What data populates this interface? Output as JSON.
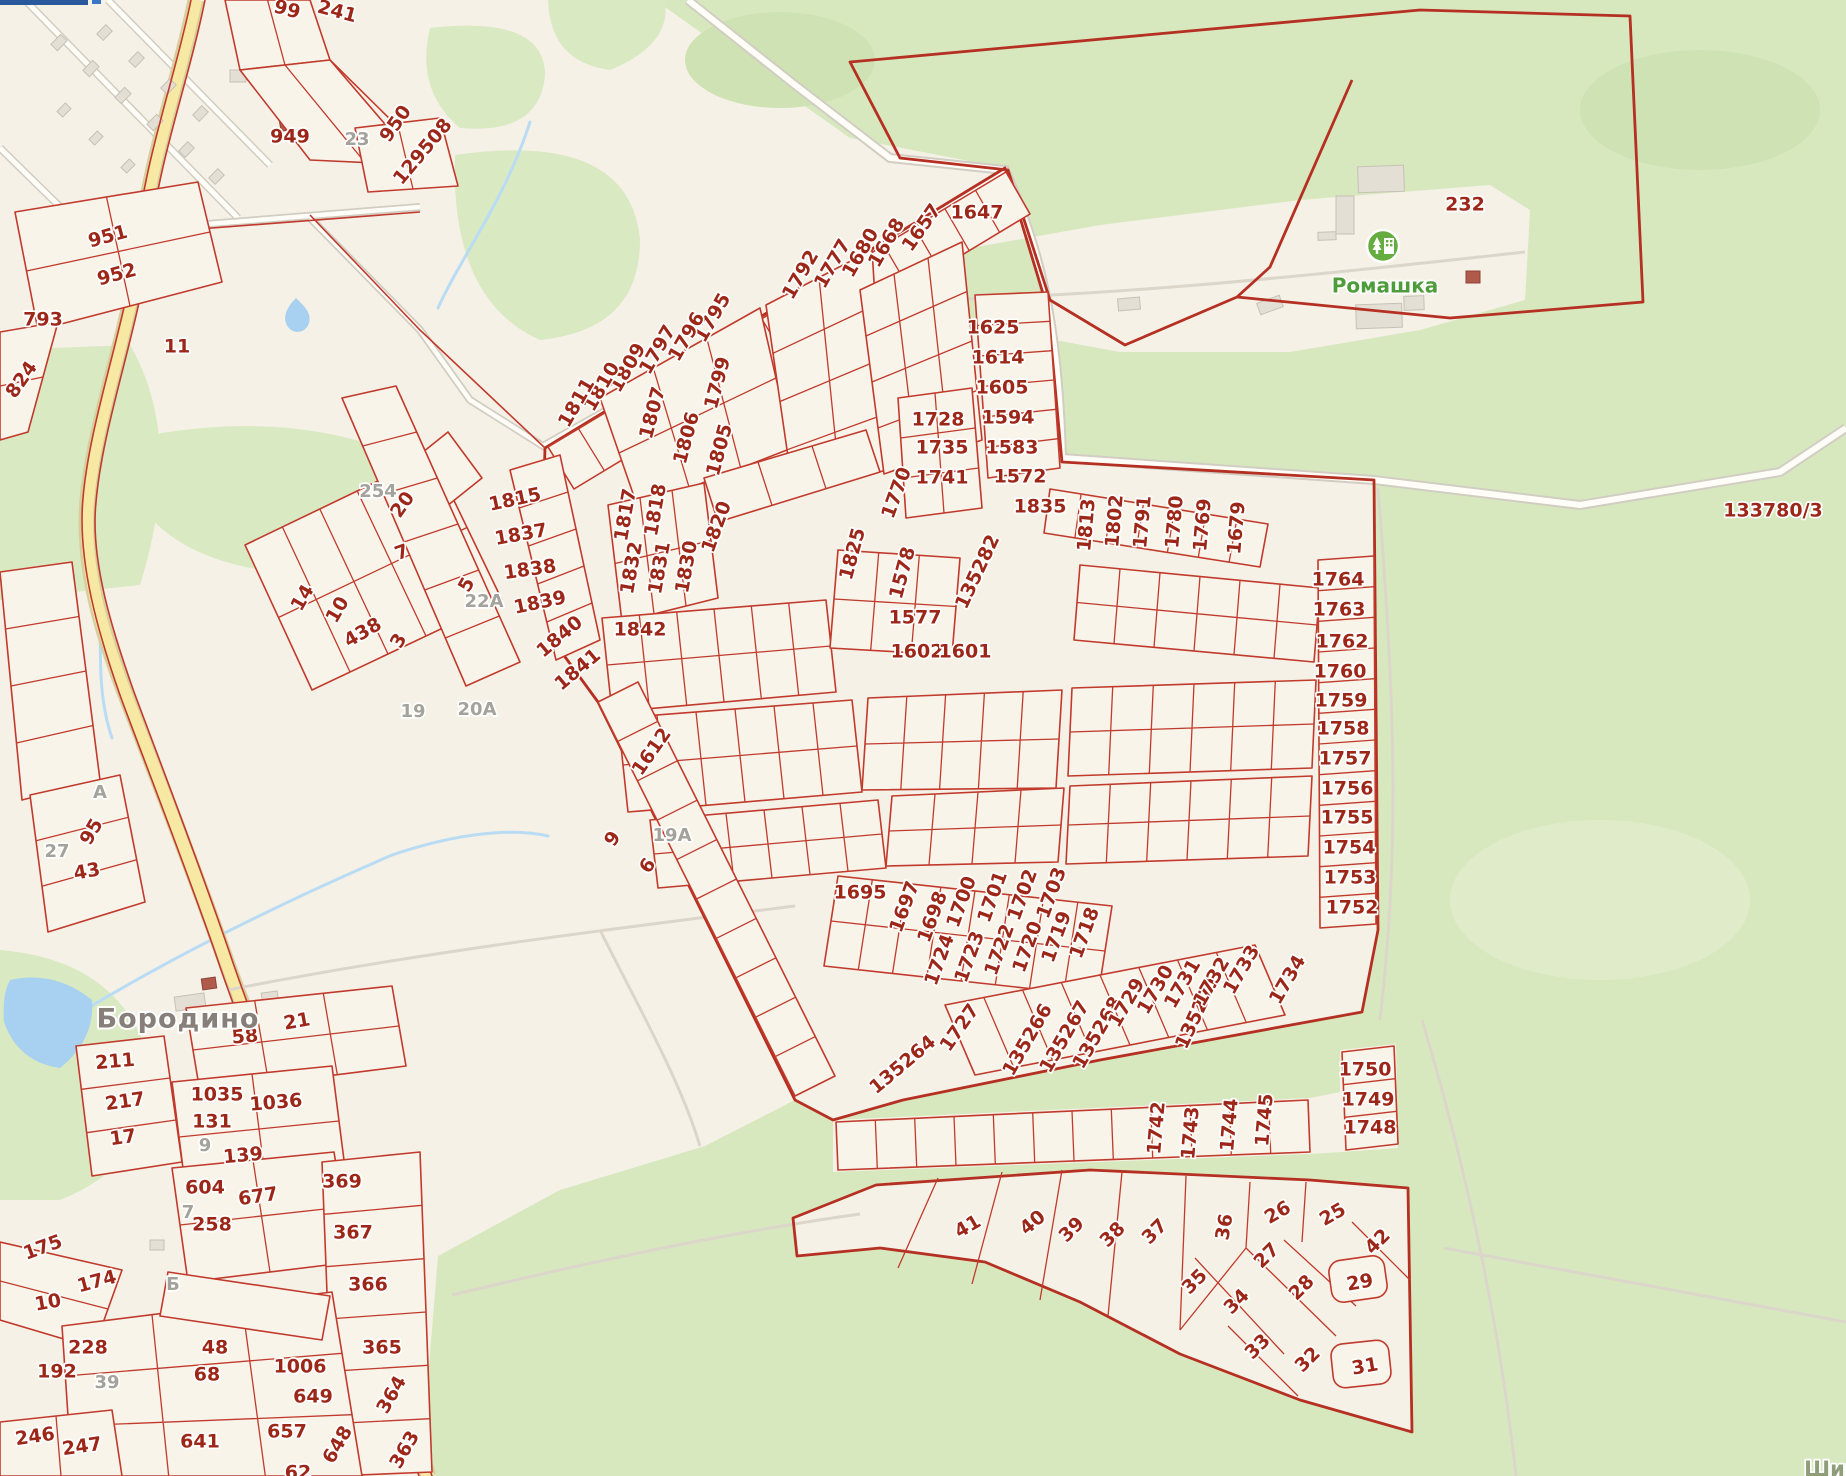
{
  "map": {
    "type": "cadastral-map",
    "colors": {
      "background": "#f5f1e6",
      "forest_green": "#d7e8bf",
      "parcel_line_red": "#c13a2c",
      "label_red": "#9c2718",
      "label_grey": "#a3a39b",
      "water_blue": "#a8d0f0",
      "road_yellow": "#f7e9a4",
      "poi_green": "#66ad41"
    },
    "places": [
      {
        "text": "Бородино",
        "x": 178,
        "y": 1020,
        "r": 0,
        "kind": "place"
      },
      {
        "text": "Ромашка",
        "x": 1385,
        "y": 287,
        "r": 0,
        "kind": "green"
      },
      {
        "text": "Шир",
        "x": 1832,
        "y": 1470,
        "r": 0,
        "kind": "street"
      }
    ],
    "poi": [
      {
        "name": "romashka-settlement-icon",
        "x": 1383,
        "y": 246
      }
    ],
    "parcels": [
      {
        "t": "99",
        "x": 287,
        "y": 10,
        "r": 15
      },
      {
        "t": "241",
        "x": 337,
        "y": 12,
        "r": 15
      },
      {
        "t": "950",
        "x": 396,
        "y": 124,
        "r": -55
      },
      {
        "t": "949",
        "x": 290,
        "y": 137,
        "r": 0
      },
      {
        "t": "23",
        "x": 357,
        "y": 140,
        "r": 0,
        "k": "grey"
      },
      {
        "t": "129508",
        "x": 423,
        "y": 152,
        "r": -50
      },
      {
        "t": "951",
        "x": 108,
        "y": 237,
        "r": -15
      },
      {
        "t": "952",
        "x": 117,
        "y": 275,
        "r": -15
      },
      {
        "t": "793",
        "x": 43,
        "y": 320,
        "r": 0
      },
      {
        "t": "11",
        "x": 177,
        "y": 347,
        "r": 0
      },
      {
        "t": "824",
        "x": 22,
        "y": 380,
        "r": -55
      },
      {
        "t": "254",
        "x": 378,
        "y": 492,
        "r": 0,
        "k": "grey"
      },
      {
        "t": "20",
        "x": 403,
        "y": 505,
        "r": -55
      },
      {
        "t": "7",
        "x": 402,
        "y": 553,
        "r": -20
      },
      {
        "t": "5",
        "x": 467,
        "y": 585,
        "r": -60
      },
      {
        "t": "22А",
        "x": 484,
        "y": 602,
        "r": 0,
        "k": "grey"
      },
      {
        "t": "14",
        "x": 303,
        "y": 598,
        "r": -60
      },
      {
        "t": "10",
        "x": 338,
        "y": 610,
        "r": -60
      },
      {
        "t": "438",
        "x": 363,
        "y": 633,
        "r": -30
      },
      {
        "t": "3",
        "x": 399,
        "y": 641,
        "r": -60
      },
      {
        "t": "19",
        "x": 413,
        "y": 712,
        "r": 0,
        "k": "grey"
      },
      {
        "t": "20А",
        "x": 477,
        "y": 710,
        "r": 0,
        "k": "grey"
      },
      {
        "t": "1647",
        "x": 977,
        "y": 213,
        "r": 0
      },
      {
        "t": "1657",
        "x": 922,
        "y": 228,
        "r": -55
      },
      {
        "t": "1668",
        "x": 887,
        "y": 243,
        "r": -60
      },
      {
        "t": "1680",
        "x": 861,
        "y": 253,
        "r": -60
      },
      {
        "t": "1777",
        "x": 833,
        "y": 264,
        "r": -60
      },
      {
        "t": "1792",
        "x": 801,
        "y": 275,
        "r": -60
      },
      {
        "t": "1795",
        "x": 713,
        "y": 318,
        "r": -60
      },
      {
        "t": "1796",
        "x": 687,
        "y": 337,
        "r": -60
      },
      {
        "t": "1797",
        "x": 658,
        "y": 350,
        "r": -60
      },
      {
        "t": "1809",
        "x": 628,
        "y": 368,
        "r": -60
      },
      {
        "t": "1810",
        "x": 602,
        "y": 387,
        "r": -60
      },
      {
        "t": "1811",
        "x": 577,
        "y": 403,
        "r": -60
      },
      {
        "t": "1799",
        "x": 718,
        "y": 383,
        "r": -75
      },
      {
        "t": "1807",
        "x": 653,
        "y": 413,
        "r": -75
      },
      {
        "t": "1806",
        "x": 687,
        "y": 438,
        "r": -75
      },
      {
        "t": "1805",
        "x": 720,
        "y": 450,
        "r": -75
      },
      {
        "t": "1625",
        "x": 993,
        "y": 328,
        "r": 0
      },
      {
        "t": "1614",
        "x": 998,
        "y": 358,
        "r": 0
      },
      {
        "t": "1605",
        "x": 1002,
        "y": 388,
        "r": 0
      },
      {
        "t": "1594",
        "x": 1008,
        "y": 418,
        "r": 0
      },
      {
        "t": "1583",
        "x": 1012,
        "y": 448,
        "r": 0
      },
      {
        "t": "1572",
        "x": 1020,
        "y": 477,
        "r": 0
      },
      {
        "t": "1728",
        "x": 938,
        "y": 420,
        "r": 0
      },
      {
        "t": "1735",
        "x": 942,
        "y": 448,
        "r": 0
      },
      {
        "t": "1741",
        "x": 942,
        "y": 478,
        "r": 0
      },
      {
        "t": "1770",
        "x": 897,
        "y": 493,
        "r": -70
      },
      {
        "t": "1835",
        "x": 1040,
        "y": 507,
        "r": 0
      },
      {
        "t": "1815",
        "x": 515,
        "y": 500,
        "r": -12
      },
      {
        "t": "1837",
        "x": 521,
        "y": 535,
        "r": -10
      },
      {
        "t": "1838",
        "x": 530,
        "y": 570,
        "r": -8
      },
      {
        "t": "1839",
        "x": 540,
        "y": 603,
        "r": -12
      },
      {
        "t": "1840",
        "x": 560,
        "y": 637,
        "r": -40
      },
      {
        "t": "1841",
        "x": 578,
        "y": 670,
        "r": -40
      },
      {
        "t": "1842",
        "x": 640,
        "y": 630,
        "r": 0
      },
      {
        "t": "1817",
        "x": 626,
        "y": 515,
        "r": -80
      },
      {
        "t": "1818",
        "x": 656,
        "y": 510,
        "r": -80
      },
      {
        "t": "1832",
        "x": 632,
        "y": 568,
        "r": -80
      },
      {
        "t": "1831",
        "x": 660,
        "y": 568,
        "r": -80
      },
      {
        "t": "1830",
        "x": 687,
        "y": 567,
        "r": -80
      },
      {
        "t": "1820",
        "x": 717,
        "y": 527,
        "r": -70
      },
      {
        "t": "1825",
        "x": 853,
        "y": 554,
        "r": -75
      },
      {
        "t": "1578",
        "x": 903,
        "y": 573,
        "r": -75
      },
      {
        "t": "1577",
        "x": 915,
        "y": 618,
        "r": 0
      },
      {
        "t": "1602",
        "x": 917,
        "y": 652,
        "r": 0
      },
      {
        "t": "1601",
        "x": 965,
        "y": 652,
        "r": 0
      },
      {
        "t": "135282",
        "x": 978,
        "y": 572,
        "r": -65
      },
      {
        "t": "1612",
        "x": 652,
        "y": 752,
        "r": -55
      },
      {
        "t": "9",
        "x": 613,
        "y": 839,
        "r": -55
      },
      {
        "t": "6",
        "x": 648,
        "y": 866,
        "r": -55
      },
      {
        "t": "19А",
        "x": 672,
        "y": 836,
        "r": 0,
        "k": "grey"
      },
      {
        "t": "1813",
        "x": 1087,
        "y": 525,
        "r": -85
      },
      {
        "t": "1802",
        "x": 1115,
        "y": 521,
        "r": -85
      },
      {
        "t": "1791",
        "x": 1143,
        "y": 522,
        "r": -85
      },
      {
        "t": "1780",
        "x": 1175,
        "y": 522,
        "r": -85
      },
      {
        "t": "1769",
        "x": 1203,
        "y": 525,
        "r": -85
      },
      {
        "t": "1679",
        "x": 1237,
        "y": 528,
        "r": -85
      },
      {
        "t": "1764",
        "x": 1338,
        "y": 580,
        "r": 0
      },
      {
        "t": "1763",
        "x": 1339,
        "y": 610,
        "r": 0
      },
      {
        "t": "1762",
        "x": 1342,
        "y": 642,
        "r": 0
      },
      {
        "t": "1760",
        "x": 1340,
        "y": 672,
        "r": 0
      },
      {
        "t": "1759",
        "x": 1341,
        "y": 701,
        "r": 0
      },
      {
        "t": "1758",
        "x": 1343,
        "y": 729,
        "r": 0
      },
      {
        "t": "1757",
        "x": 1345,
        "y": 759,
        "r": 0
      },
      {
        "t": "1756",
        "x": 1347,
        "y": 789,
        "r": 0
      },
      {
        "t": "1755",
        "x": 1347,
        "y": 818,
        "r": 0
      },
      {
        "t": "1754",
        "x": 1349,
        "y": 848,
        "r": 0
      },
      {
        "t": "1753",
        "x": 1350,
        "y": 878,
        "r": 0
      },
      {
        "t": "1752",
        "x": 1352,
        "y": 908,
        "r": 0
      },
      {
        "t": "1695",
        "x": 860,
        "y": 893,
        "r": 0
      },
      {
        "t": "1697",
        "x": 905,
        "y": 907,
        "r": -70
      },
      {
        "t": "1698",
        "x": 933,
        "y": 917,
        "r": -70
      },
      {
        "t": "1700",
        "x": 962,
        "y": 902,
        "r": -70
      },
      {
        "t": "1701",
        "x": 993,
        "y": 897,
        "r": -70
      },
      {
        "t": "1702",
        "x": 1023,
        "y": 895,
        "r": -70
      },
      {
        "t": "1703",
        "x": 1052,
        "y": 893,
        "r": -70
      },
      {
        "t": "1719",
        "x": 1057,
        "y": 937,
        "r": -70
      },
      {
        "t": "1718",
        "x": 1085,
        "y": 933,
        "r": -70
      },
      {
        "t": "1724",
        "x": 940,
        "y": 960,
        "r": -70
      },
      {
        "t": "1723",
        "x": 970,
        "y": 957,
        "r": -70
      },
      {
        "t": "1722",
        "x": 1000,
        "y": 950,
        "r": -70
      },
      {
        "t": "1720",
        "x": 1028,
        "y": 947,
        "r": -70
      },
      {
        "t": "1727",
        "x": 960,
        "y": 1028,
        "r": -55
      },
      {
        "t": "135264",
        "x": 903,
        "y": 1065,
        "r": -40
      },
      {
        "t": "135266",
        "x": 1028,
        "y": 1040,
        "r": -60
      },
      {
        "t": "135267",
        "x": 1065,
        "y": 1037,
        "r": -60
      },
      {
        "t": "135268",
        "x": 1098,
        "y": 1033,
        "r": -60
      },
      {
        "t": "1729",
        "x": 1127,
        "y": 1003,
        "r": -60
      },
      {
        "t": "1730",
        "x": 1156,
        "y": 990,
        "r": -60
      },
      {
        "t": "1731",
        "x": 1183,
        "y": 984,
        "r": -60
      },
      {
        "t": "135271",
        "x": 1198,
        "y": 1012,
        "r": -65
      },
      {
        "t": "1732",
        "x": 1212,
        "y": 982,
        "r": -60
      },
      {
        "t": "1733",
        "x": 1242,
        "y": 970,
        "r": -60
      },
      {
        "t": "1734",
        "x": 1288,
        "y": 980,
        "r": -60
      },
      {
        "t": "1742",
        "x": 1157,
        "y": 1128,
        "r": -85
      },
      {
        "t": "1743",
        "x": 1191,
        "y": 1133,
        "r": -85
      },
      {
        "t": "1744",
        "x": 1230,
        "y": 1125,
        "r": -85
      },
      {
        "t": "1745",
        "x": 1265,
        "y": 1120,
        "r": -85
      },
      {
        "t": "1750",
        "x": 1365,
        "y": 1070,
        "r": 0
      },
      {
        "t": "1749",
        "x": 1368,
        "y": 1100,
        "r": 0
      },
      {
        "t": "1748",
        "x": 1370,
        "y": 1128,
        "r": 0
      },
      {
        "t": "41",
        "x": 968,
        "y": 1227,
        "r": -30
      },
      {
        "t": "40",
        "x": 1033,
        "y": 1223,
        "r": -40
      },
      {
        "t": "39",
        "x": 1072,
        "y": 1230,
        "r": -45
      },
      {
        "t": "38",
        "x": 1113,
        "y": 1235,
        "r": -45
      },
      {
        "t": "37",
        "x": 1155,
        "y": 1232,
        "r": -45
      },
      {
        "t": "36",
        "x": 1225,
        "y": 1227,
        "r": -80
      },
      {
        "t": "35",
        "x": 1195,
        "y": 1282,
        "r": -45
      },
      {
        "t": "34",
        "x": 1237,
        "y": 1302,
        "r": -45
      },
      {
        "t": "33",
        "x": 1258,
        "y": 1347,
        "r": -45
      },
      {
        "t": "32",
        "x": 1308,
        "y": 1360,
        "r": -45
      },
      {
        "t": "31",
        "x": 1365,
        "y": 1367,
        "r": -10
      },
      {
        "t": "29",
        "x": 1360,
        "y": 1283,
        "r": -10
      },
      {
        "t": "28",
        "x": 1302,
        "y": 1288,
        "r": -45
      },
      {
        "t": "27",
        "x": 1267,
        "y": 1256,
        "r": -45
      },
      {
        "t": "26",
        "x": 1278,
        "y": 1213,
        "r": -30
      },
      {
        "t": "25",
        "x": 1333,
        "y": 1215,
        "r": -30
      },
      {
        "t": "42",
        "x": 1378,
        "y": 1242,
        "r": -45
      },
      {
        "t": "232",
        "x": 1465,
        "y": 205,
        "r": 0
      },
      {
        "t": "133780/3",
        "x": 1773,
        "y": 511,
        "r": 0
      },
      {
        "t": "43",
        "x": 87,
        "y": 872,
        "r": -10
      },
      {
        "t": "95",
        "x": 92,
        "y": 832,
        "r": -60
      },
      {
        "t": "27",
        "x": 57,
        "y": 852,
        "r": 0,
        "k": "grey"
      },
      {
        "t": "А",
        "x": 100,
        "y": 793,
        "r": 0,
        "k": "grey"
      },
      {
        "t": "21",
        "x": 297,
        "y": 1022,
        "r": -10
      },
      {
        "t": "58",
        "x": 245,
        "y": 1037,
        "r": -5
      },
      {
        "t": "211",
        "x": 115,
        "y": 1062,
        "r": -5
      },
      {
        "t": "217",
        "x": 125,
        "y": 1102,
        "r": -8
      },
      {
        "t": "17",
        "x": 123,
        "y": 1138,
        "r": -8
      },
      {
        "t": "1035",
        "x": 217,
        "y": 1095,
        "r": 0
      },
      {
        "t": "1036",
        "x": 276,
        "y": 1103,
        "r": -5
      },
      {
        "t": "131",
        "x": 212,
        "y": 1122,
        "r": 0
      },
      {
        "t": "9",
        "x": 205,
        "y": 1146,
        "r": 0,
        "k": "grey"
      },
      {
        "t": "139",
        "x": 243,
        "y": 1156,
        "r": -5
      },
      {
        "t": "604",
        "x": 205,
        "y": 1188,
        "r": 0
      },
      {
        "t": "677",
        "x": 258,
        "y": 1197,
        "r": -8
      },
      {
        "t": "369",
        "x": 342,
        "y": 1182,
        "r": 0
      },
      {
        "t": "258",
        "x": 212,
        "y": 1225,
        "r": 0
      },
      {
        "t": "7",
        "x": 188,
        "y": 1213,
        "r": 0,
        "k": "grey"
      },
      {
        "t": "367",
        "x": 353,
        "y": 1233,
        "r": 0
      },
      {
        "t": "175",
        "x": 43,
        "y": 1248,
        "r": -20
      },
      {
        "t": "174",
        "x": 97,
        "y": 1282,
        "r": -15
      },
      {
        "t": "366",
        "x": 368,
        "y": 1285,
        "r": 0
      },
      {
        "t": "10",
        "x": 48,
        "y": 1303,
        "r": -10
      },
      {
        "t": "228",
        "x": 88,
        "y": 1348,
        "r": 0
      },
      {
        "t": "192",
        "x": 57,
        "y": 1372,
        "r": 0
      },
      {
        "t": "39",
        "x": 107,
        "y": 1383,
        "r": 0,
        "k": "grey"
      },
      {
        "t": "48",
        "x": 215,
        "y": 1348,
        "r": 0
      },
      {
        "t": "68",
        "x": 207,
        "y": 1375,
        "r": 0
      },
      {
        "t": "1006",
        "x": 300,
        "y": 1367,
        "r": 0
      },
      {
        "t": "649",
        "x": 313,
        "y": 1397,
        "r": 0
      },
      {
        "t": "365",
        "x": 382,
        "y": 1348,
        "r": 0
      },
      {
        "t": "364",
        "x": 392,
        "y": 1395,
        "r": -60
      },
      {
        "t": "363",
        "x": 405,
        "y": 1450,
        "r": -60
      },
      {
        "t": "657",
        "x": 287,
        "y": 1432,
        "r": 0
      },
      {
        "t": "641",
        "x": 200,
        "y": 1442,
        "r": 0
      },
      {
        "t": "648",
        "x": 338,
        "y": 1445,
        "r": -60
      },
      {
        "t": "246",
        "x": 35,
        "y": 1437,
        "r": -8
      },
      {
        "t": "247",
        "x": 82,
        "y": 1447,
        "r": -8
      },
      {
        "t": "Б",
        "x": 173,
        "y": 1285,
        "r": 0,
        "k": "grey"
      },
      {
        "t": "62",
        "x": 298,
        "y": 1473,
        "r": 0
      }
    ]
  }
}
